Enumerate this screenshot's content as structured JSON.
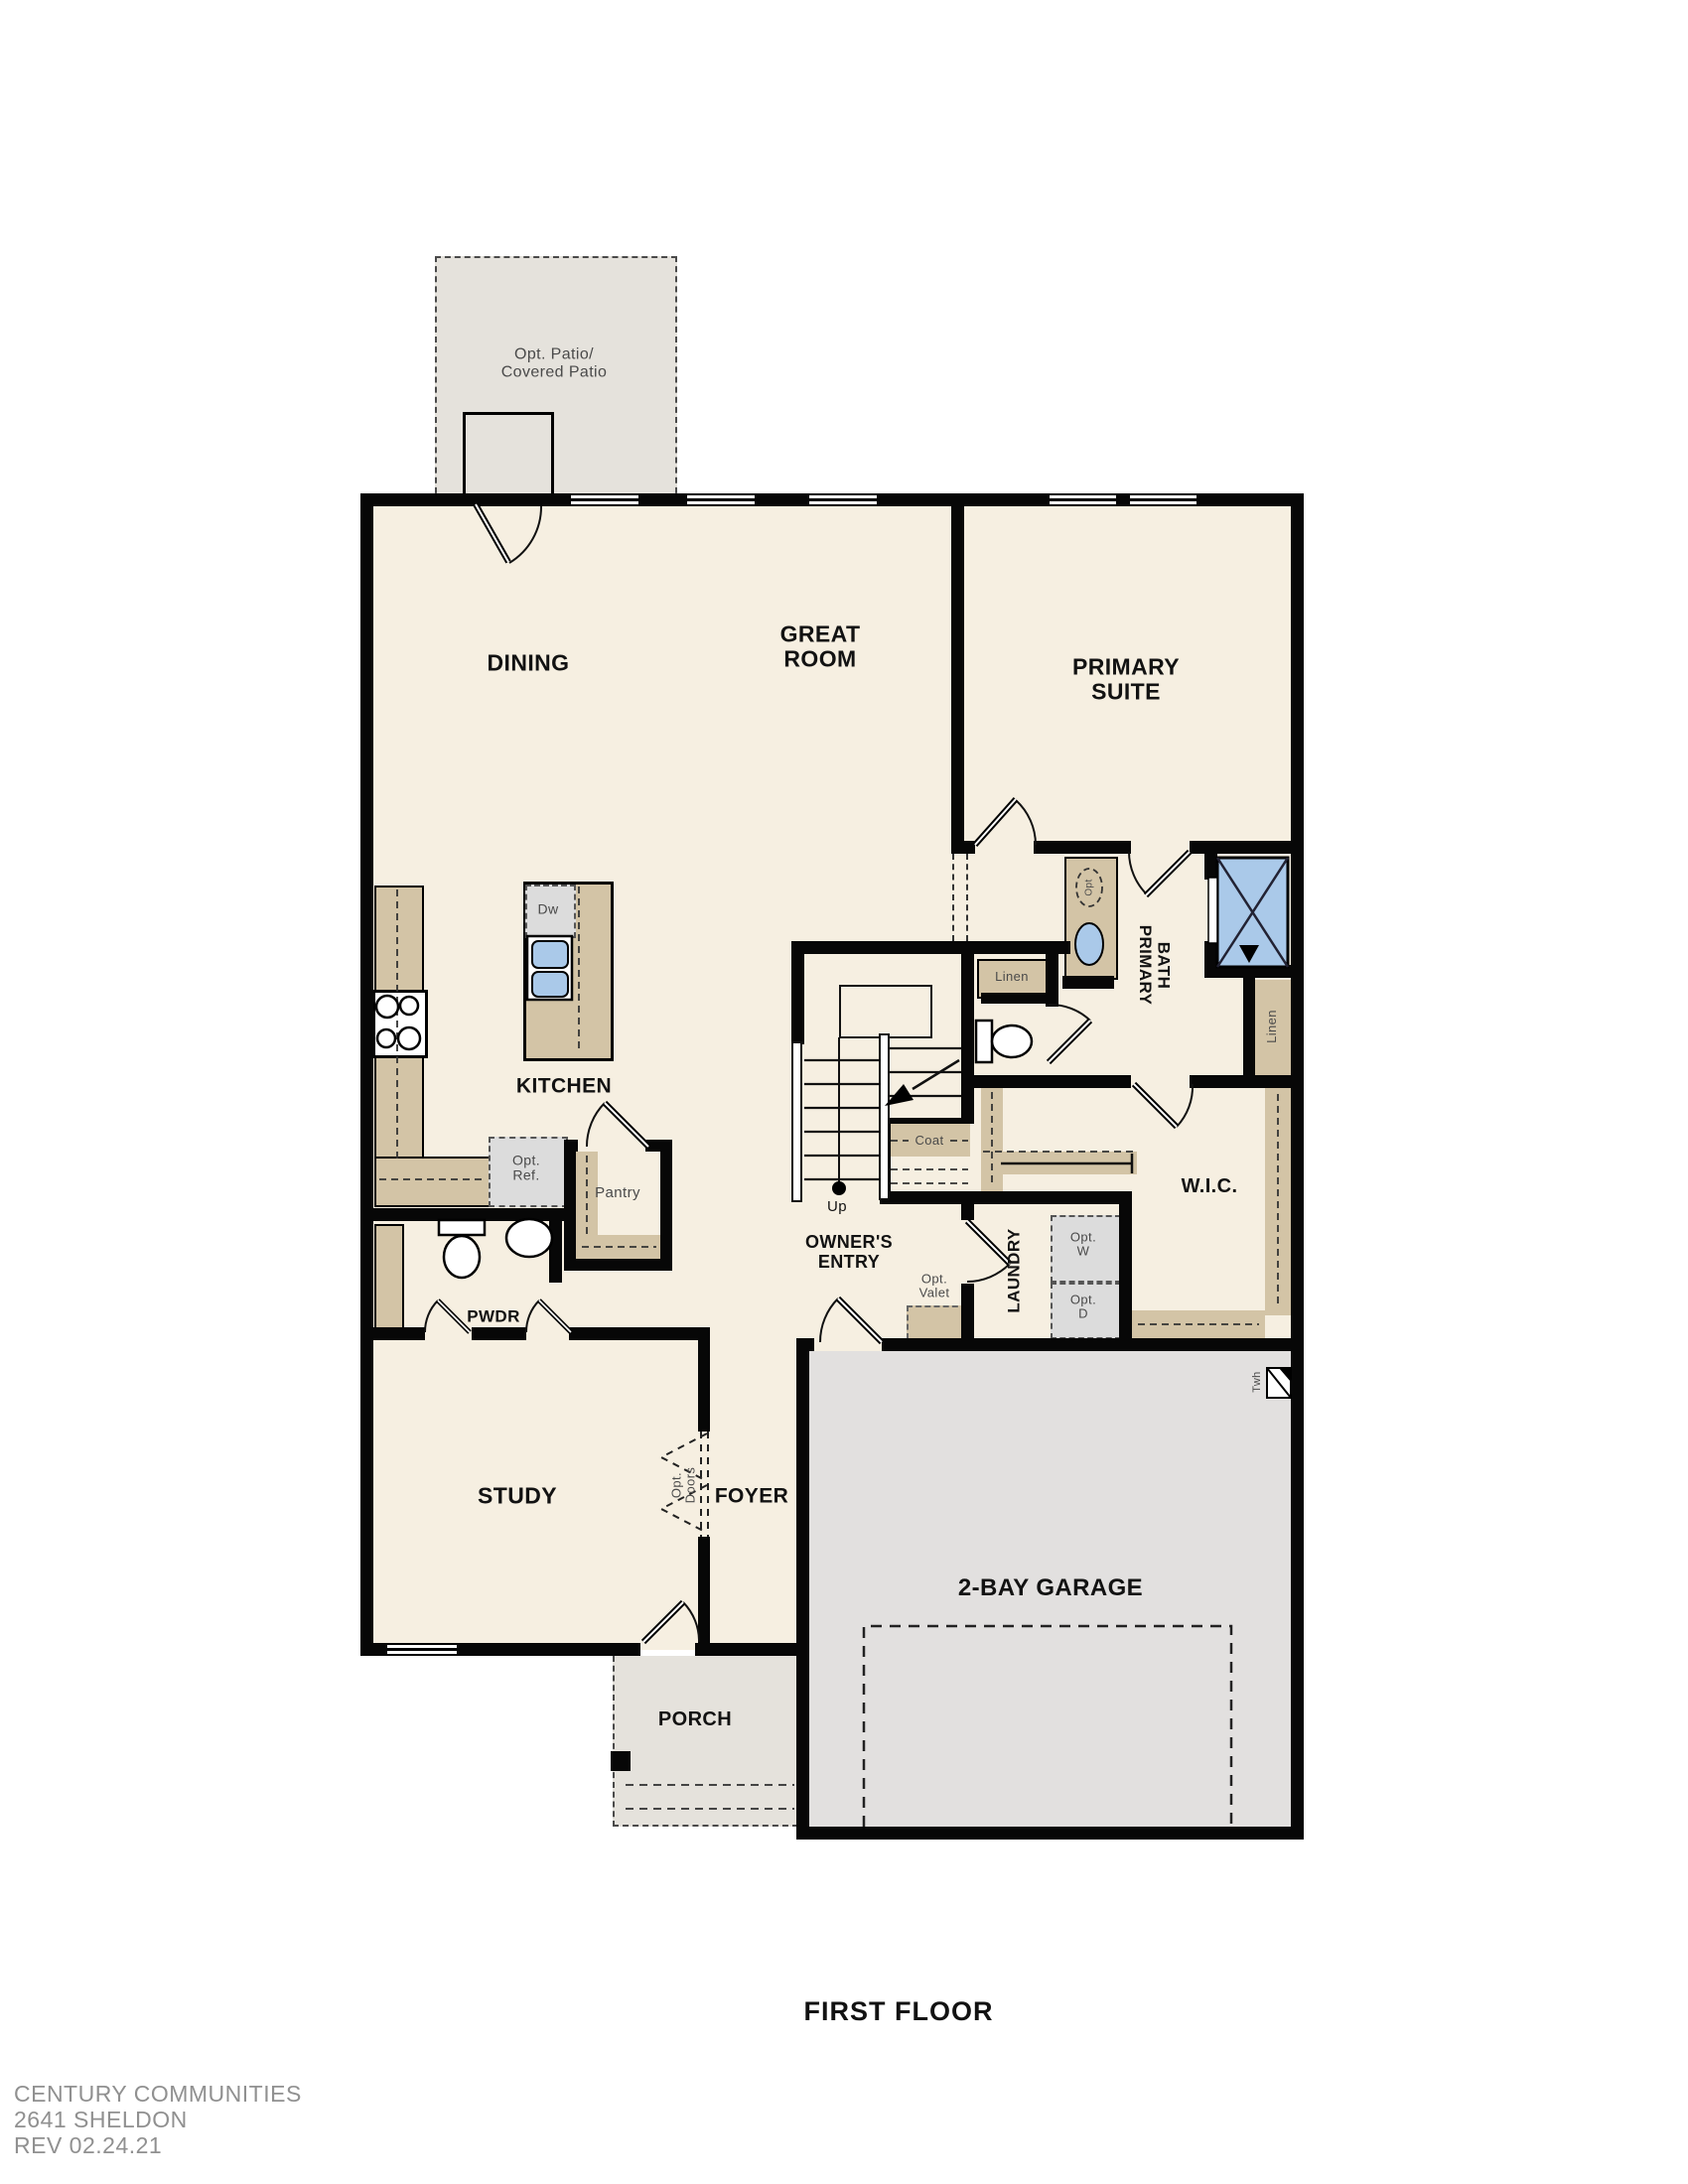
{
  "title": "FIRST FLOOR",
  "footer": {
    "company": "CENTURY COMMUNITIES",
    "plan": "2641 SHELDON",
    "revision": "REV 02.24.21"
  },
  "rooms": {
    "patio": "Opt. Patio/\nCovered Patio",
    "dining": "DINING",
    "great_room": "GREAT\nROOM",
    "primary_suite": "PRIMARY\nSUITE",
    "kitchen": "KITCHEN",
    "pantry": "Pantry",
    "pwdr": "PWDR",
    "study": "STUDY",
    "foyer": "FOYER",
    "owners_entry": "OWNER'S\nENTRY",
    "laundry": "LAUNDRY",
    "wic": "W.I.C.",
    "primary_bath": "PRIMARY\nBATH",
    "garage": "2-BAY GARAGE",
    "porch": "PORCH"
  },
  "features": {
    "dw": "Dw",
    "opt_ref": "Opt.\nRef.",
    "opt_doors": "Opt.\nDoors",
    "coat": "Coat",
    "up": "Up",
    "opt_valet": "Opt.\nValet",
    "opt_w": "Opt.\nW",
    "opt_d": "Opt.\nD",
    "linen_hall": "Linen",
    "linen_bath": "Linen",
    "opt_tub": "Opt",
    "twh": "Twh"
  },
  "colors": {
    "floor": "#f6efe1",
    "patio_porch": "#e5e2dc",
    "garage": "#e2e0df",
    "counter_tan": "#d3c4a6",
    "appliance_gray": "#dcdcdc",
    "fixture_blue": "#aac9e9",
    "wall": "#070707",
    "label": "#121212",
    "footer_text": "#909090"
  }
}
